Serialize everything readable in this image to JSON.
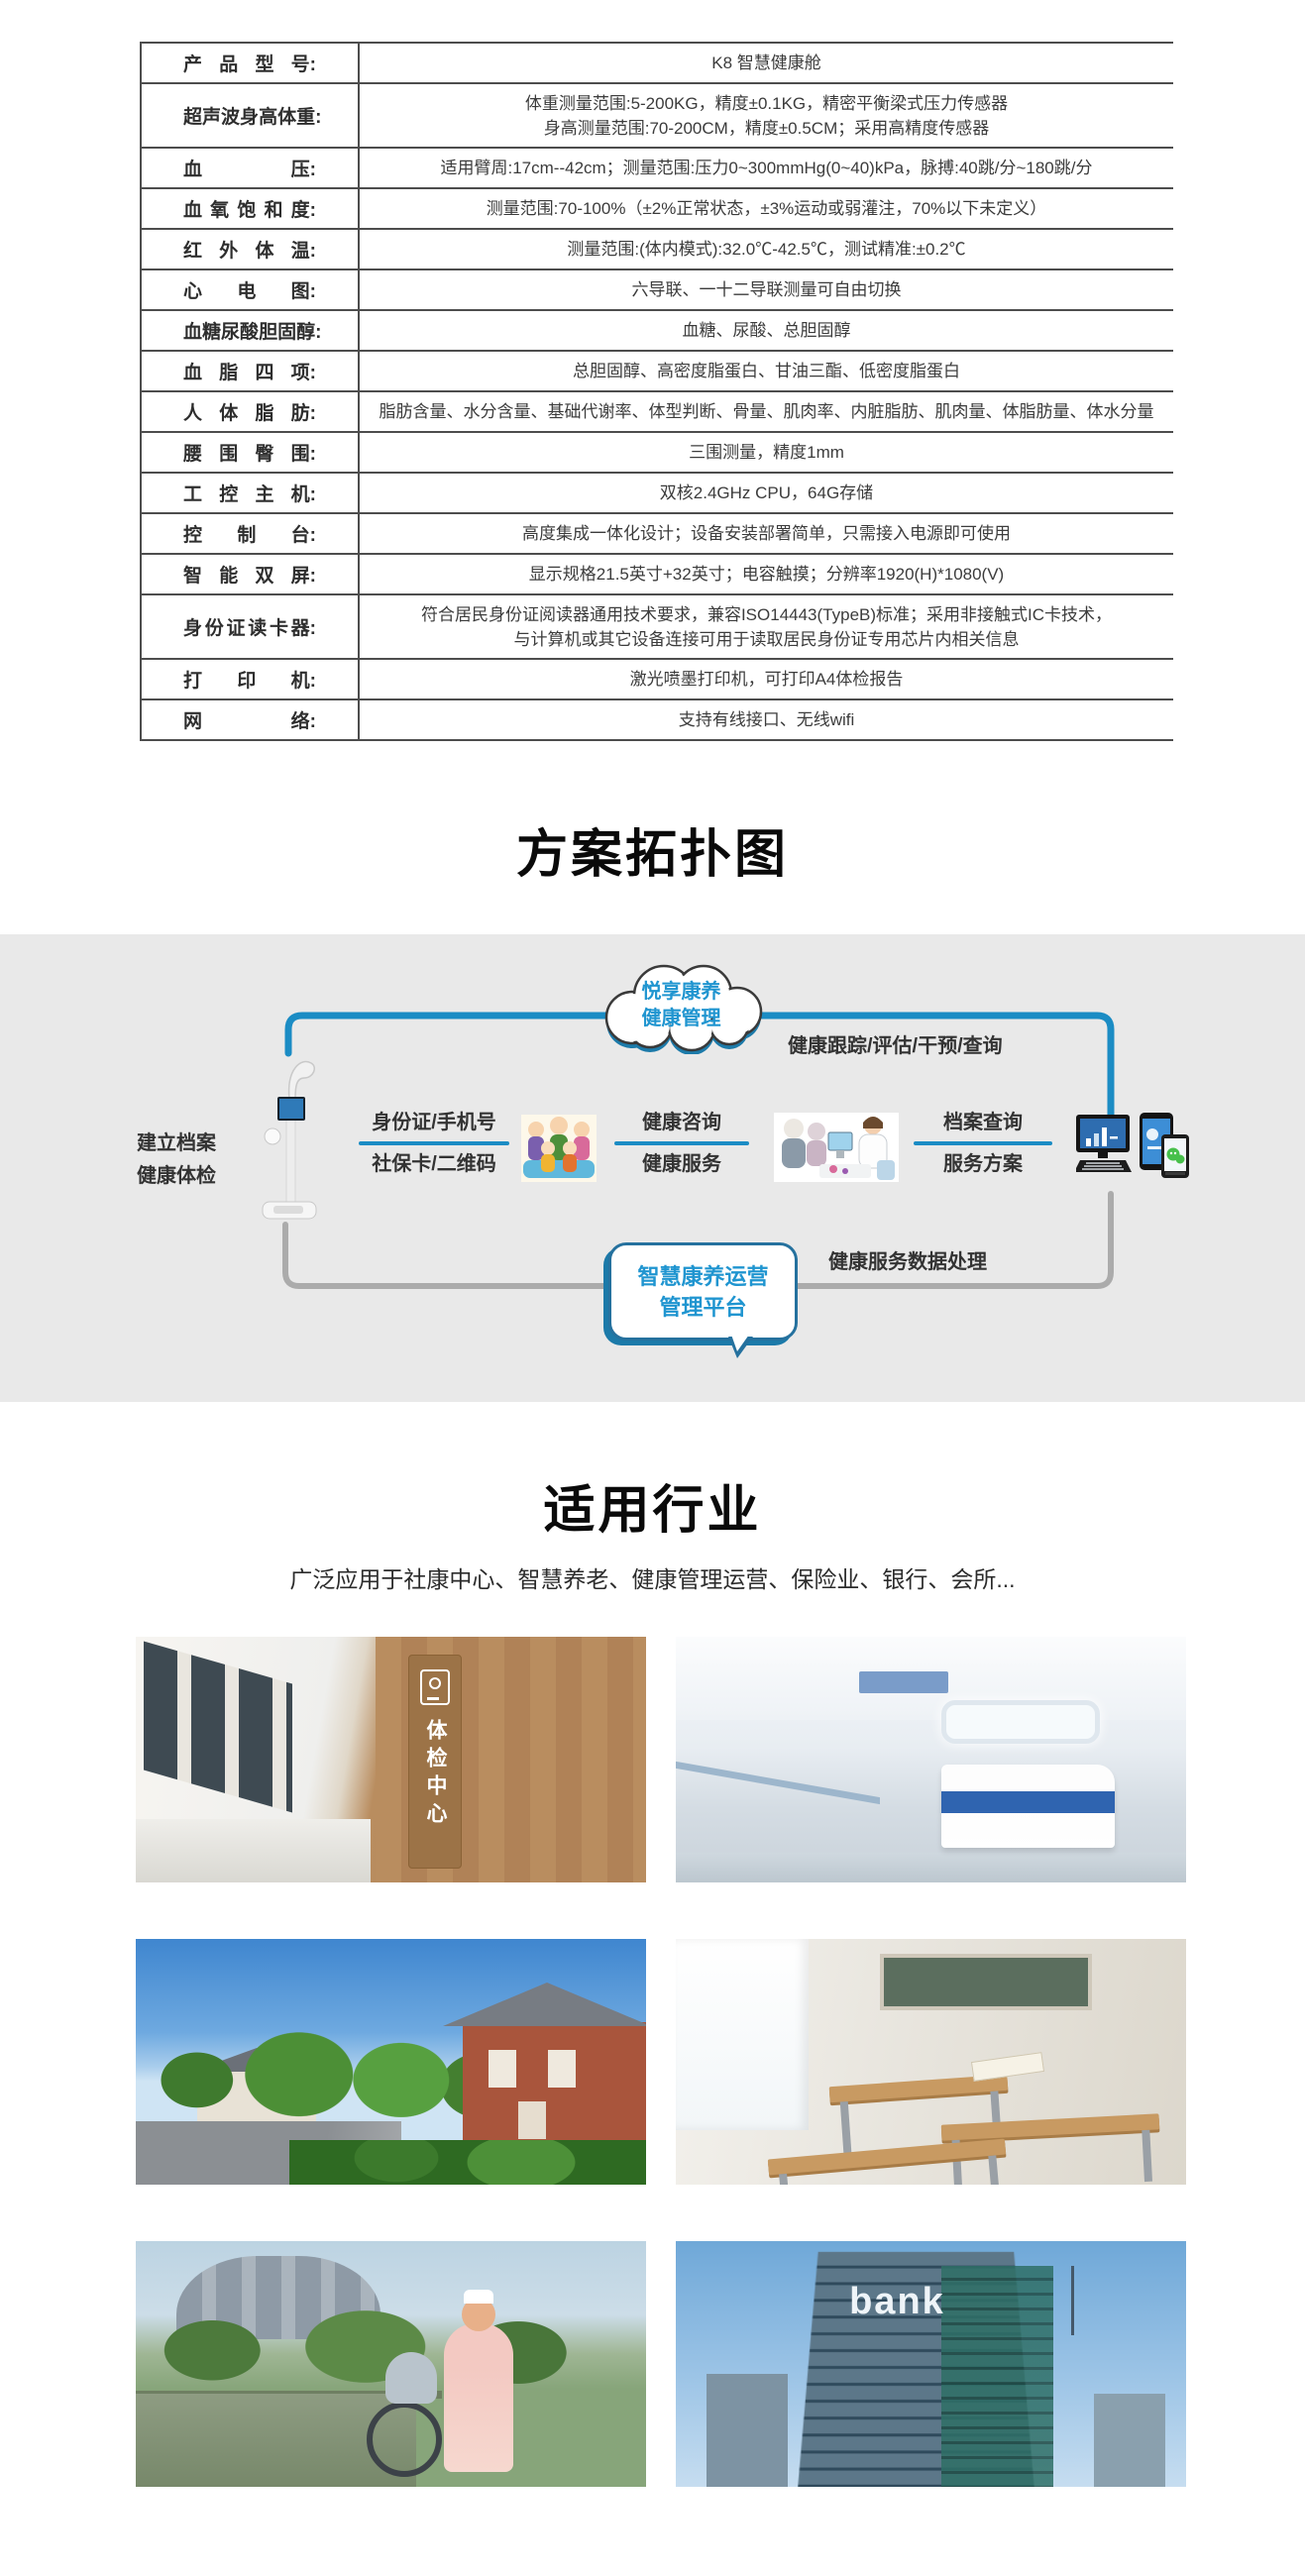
{
  "spec_table": {
    "rows": [
      {
        "label": "产品型号:",
        "value": "K8 智慧健康舱"
      },
      {
        "label": "超声波身高体重:",
        "value": "体重测量范围:5-200KG，精度±0.1KG，精密平衡梁式压力传感器\n身高测量范围:70-200CM，精度±0.5CM；采用高精度传感器"
      },
      {
        "label": "血压:",
        "value": "适用臂周:17cm--42cm；测量范围:压力0~300mmHg(0~40)kPa，脉搏:40跳/分~180跳/分"
      },
      {
        "label": "血氧饱和度:",
        "value": "测量范围:70-100%（±2%正常状态，±3%运动或弱灌注，70%以下未定义）"
      },
      {
        "label": "红外体温:",
        "value": "测量范围:(体内模式):32.0℃-42.5℃，测试精准:±0.2℃"
      },
      {
        "label": "心电图:",
        "value": "六导联、一十二导联测量可自由切换"
      },
      {
        "label": "血糖尿酸胆固醇:",
        "value": "血糖、尿酸、总胆固醇"
      },
      {
        "label": "血脂四项:",
        "value": "总胆固醇、高密度脂蛋白、甘油三酯、低密度脂蛋白"
      },
      {
        "label": "人体脂肪:",
        "value": "脂肪含量、水分含量、基础代谢率、体型判断、骨量、肌肉率、内脏脂肪、肌肉量、体脂肪量、体水分量"
      },
      {
        "label": "腰围臀围:",
        "value": "三围测量，精度1mm"
      },
      {
        "label": "工控主机:",
        "value": "双核2.4GHz CPU，64G存储"
      },
      {
        "label": "控制台:",
        "value": "高度集成一体化设计；设备安装部署简单，只需接入电源即可使用"
      },
      {
        "label": "智能双屏:",
        "value": "显示规格21.5英寸+32英寸；电容触摸；分辨率1920(H)*1080(V)"
      },
      {
        "label": "身份证读卡器:",
        "value": "符合居民身份证阅读器通用技术要求，兼容ISO14443(TypeB)标准；采用非接触式IC卡技术，\n与计算机或其它设备连接可用于读取居民身份证专用芯片内相关信息"
      },
      {
        "label": "打印机:",
        "value": "激光喷墨打印机，可打印A4体检报告"
      },
      {
        "label": "网络:",
        "value": "支持有线接口、无线wifi"
      }
    ]
  },
  "topology": {
    "section_title": "方案拓扑图",
    "cloud": {
      "line1": "悦享康养",
      "line2": "健康管理"
    },
    "left_label": {
      "line1": "建立档案",
      "line2": "健康体检"
    },
    "top_flow_label": "健康跟踪/评估/干预/查询",
    "bottom_flow_label": "健康服务数据处理",
    "bubble": {
      "line1": "智慧康养运营",
      "line2": "管理平台"
    },
    "pairs": [
      {
        "top": "身份证/手机号",
        "bottom": "社保卡/二维码"
      },
      {
        "top": "健康咨询",
        "bottom": "健康服务"
      },
      {
        "top": "档案查询",
        "bottom": "服务方案"
      }
    ],
    "illustrations": {
      "kiosk": "health-check-kiosk",
      "family": "family-cartoon",
      "consult": "doctor-consultation-cartoon",
      "devices": "computer-and-phones"
    },
    "colors": {
      "line_blue": "#1b8cc4",
      "line_gray": "#ababab",
      "text_blue": "#2095d0",
      "section_bg": "#e9e9e9"
    }
  },
  "industries": {
    "section_title": "适用行业",
    "subtitle": "广泛应用于社康中心、智慧养老、健康管理运营、保险业、银行、会所...",
    "caption_bg": "#1280b0",
    "cards": [
      {
        "caption": "健康小屋",
        "photo": "health-hut-corridor",
        "overlay_text": "体检中心"
      },
      {
        "caption": "医院",
        "photo": "hospital-corridor",
        "overlay_text": ""
      },
      {
        "caption": "社区",
        "photo": "community-street",
        "overlay_text": ""
      },
      {
        "caption": "学校",
        "photo": "school-classroom",
        "overlay_text": ""
      },
      {
        "caption": "养老机构",
        "photo": "nursing-home-garden",
        "overlay_text": ""
      },
      {
        "caption": "银行",
        "photo": "bank-building",
        "overlay_text": "bank"
      }
    ]
  }
}
